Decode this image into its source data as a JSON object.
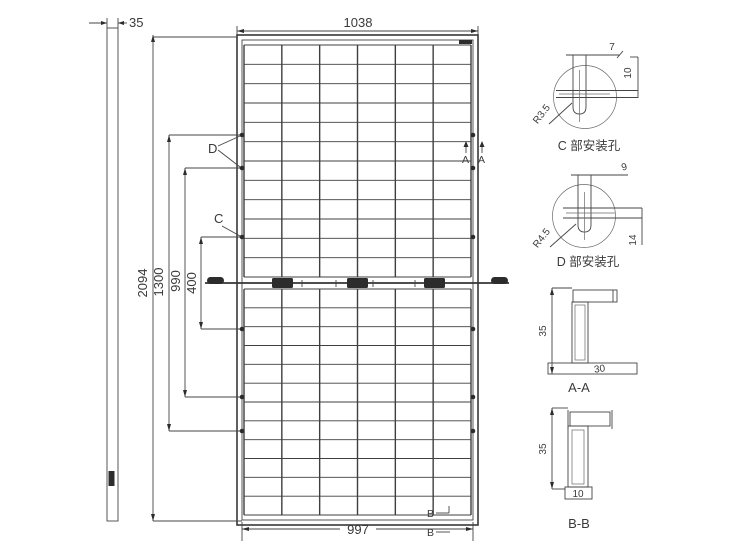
{
  "dimensions": {
    "frame_thickness": "35",
    "module_width": "1038",
    "module_height": "2094",
    "hole_spacing_outer": "1300",
    "hole_spacing_mid": "990",
    "hole_spacing_inner": "400",
    "back_width": "997"
  },
  "section_labels": {
    "a": "A",
    "b": "B",
    "c": "C",
    "d": "D"
  },
  "grid": {
    "cols": 6,
    "rows_upper": 12,
    "rows_lower": 12
  },
  "details": {
    "c": {
      "title": "C 部安装孔",
      "slot_width": "7",
      "slot_length": "10",
      "radius": "R3.5"
    },
    "d": {
      "title": "D 部安装孔",
      "slot_width": "9",
      "slot_length": "14",
      "radius": "R4.5"
    },
    "aa": {
      "title": "A-A",
      "height": "35",
      "width": "30"
    },
    "bb": {
      "title": "B-B",
      "height": "35",
      "width": "10"
    }
  }
}
